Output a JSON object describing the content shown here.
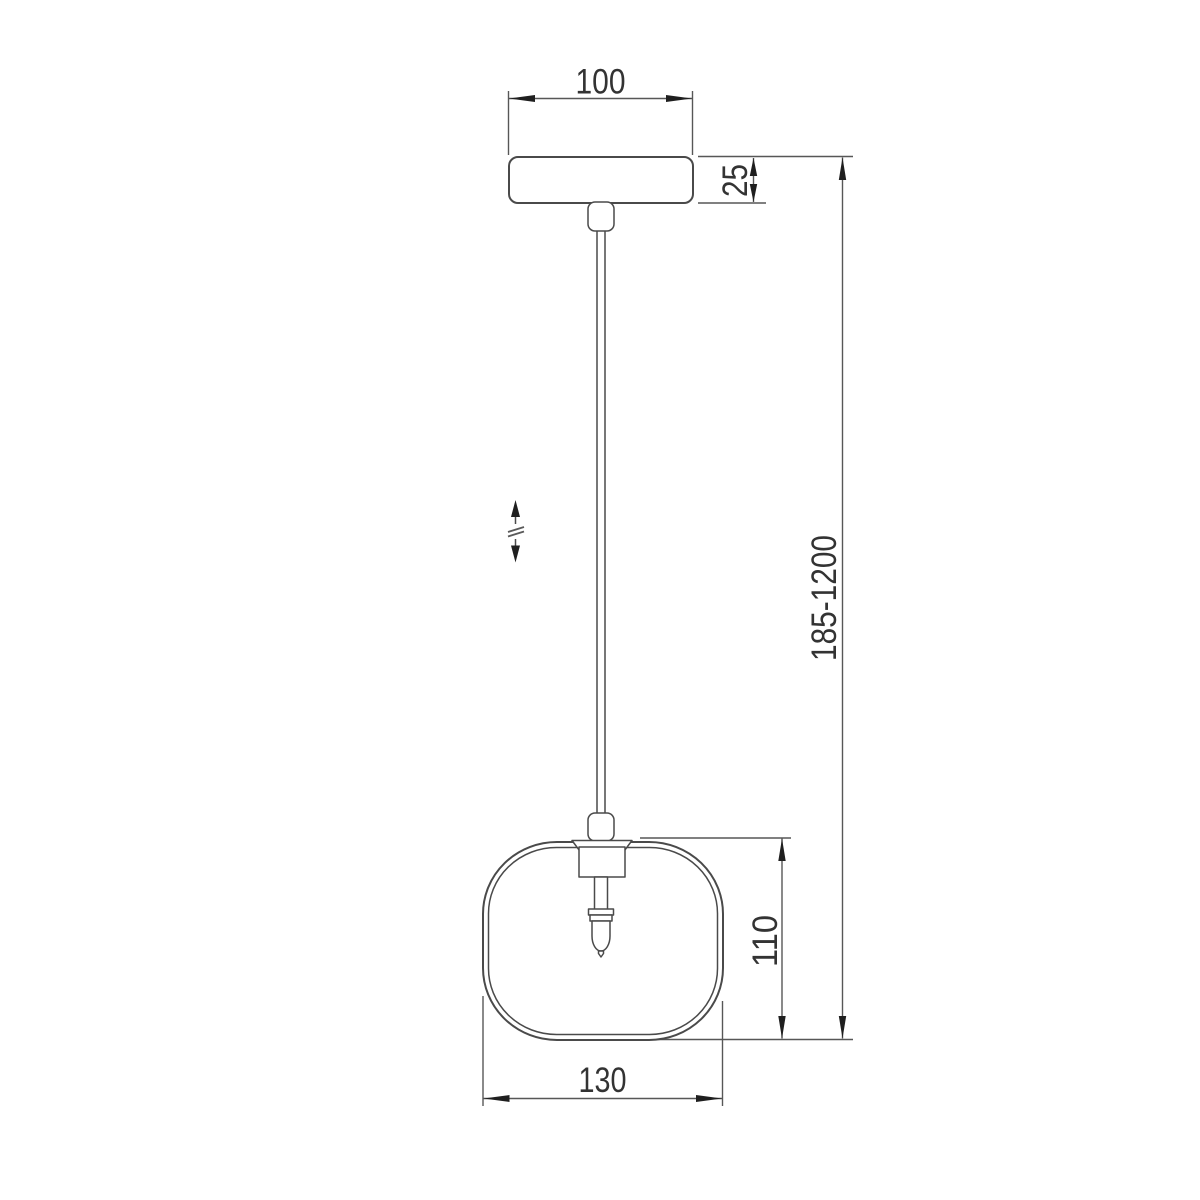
{
  "drawing": {
    "labels": {
      "canopy_width": "100",
      "canopy_height": "25",
      "suspension_height_range": "185-1200",
      "shade_height": "110",
      "shade_width": "130"
    },
    "colors": {
      "background": "#ffffff",
      "object_line": "#4a4a4a",
      "dimension_line": "#575757",
      "arrow": "#1f1f1f",
      "text": "#333333"
    },
    "icons": {
      "adjustable_height": "up-down-arrows-with-break-symbol"
    }
  }
}
